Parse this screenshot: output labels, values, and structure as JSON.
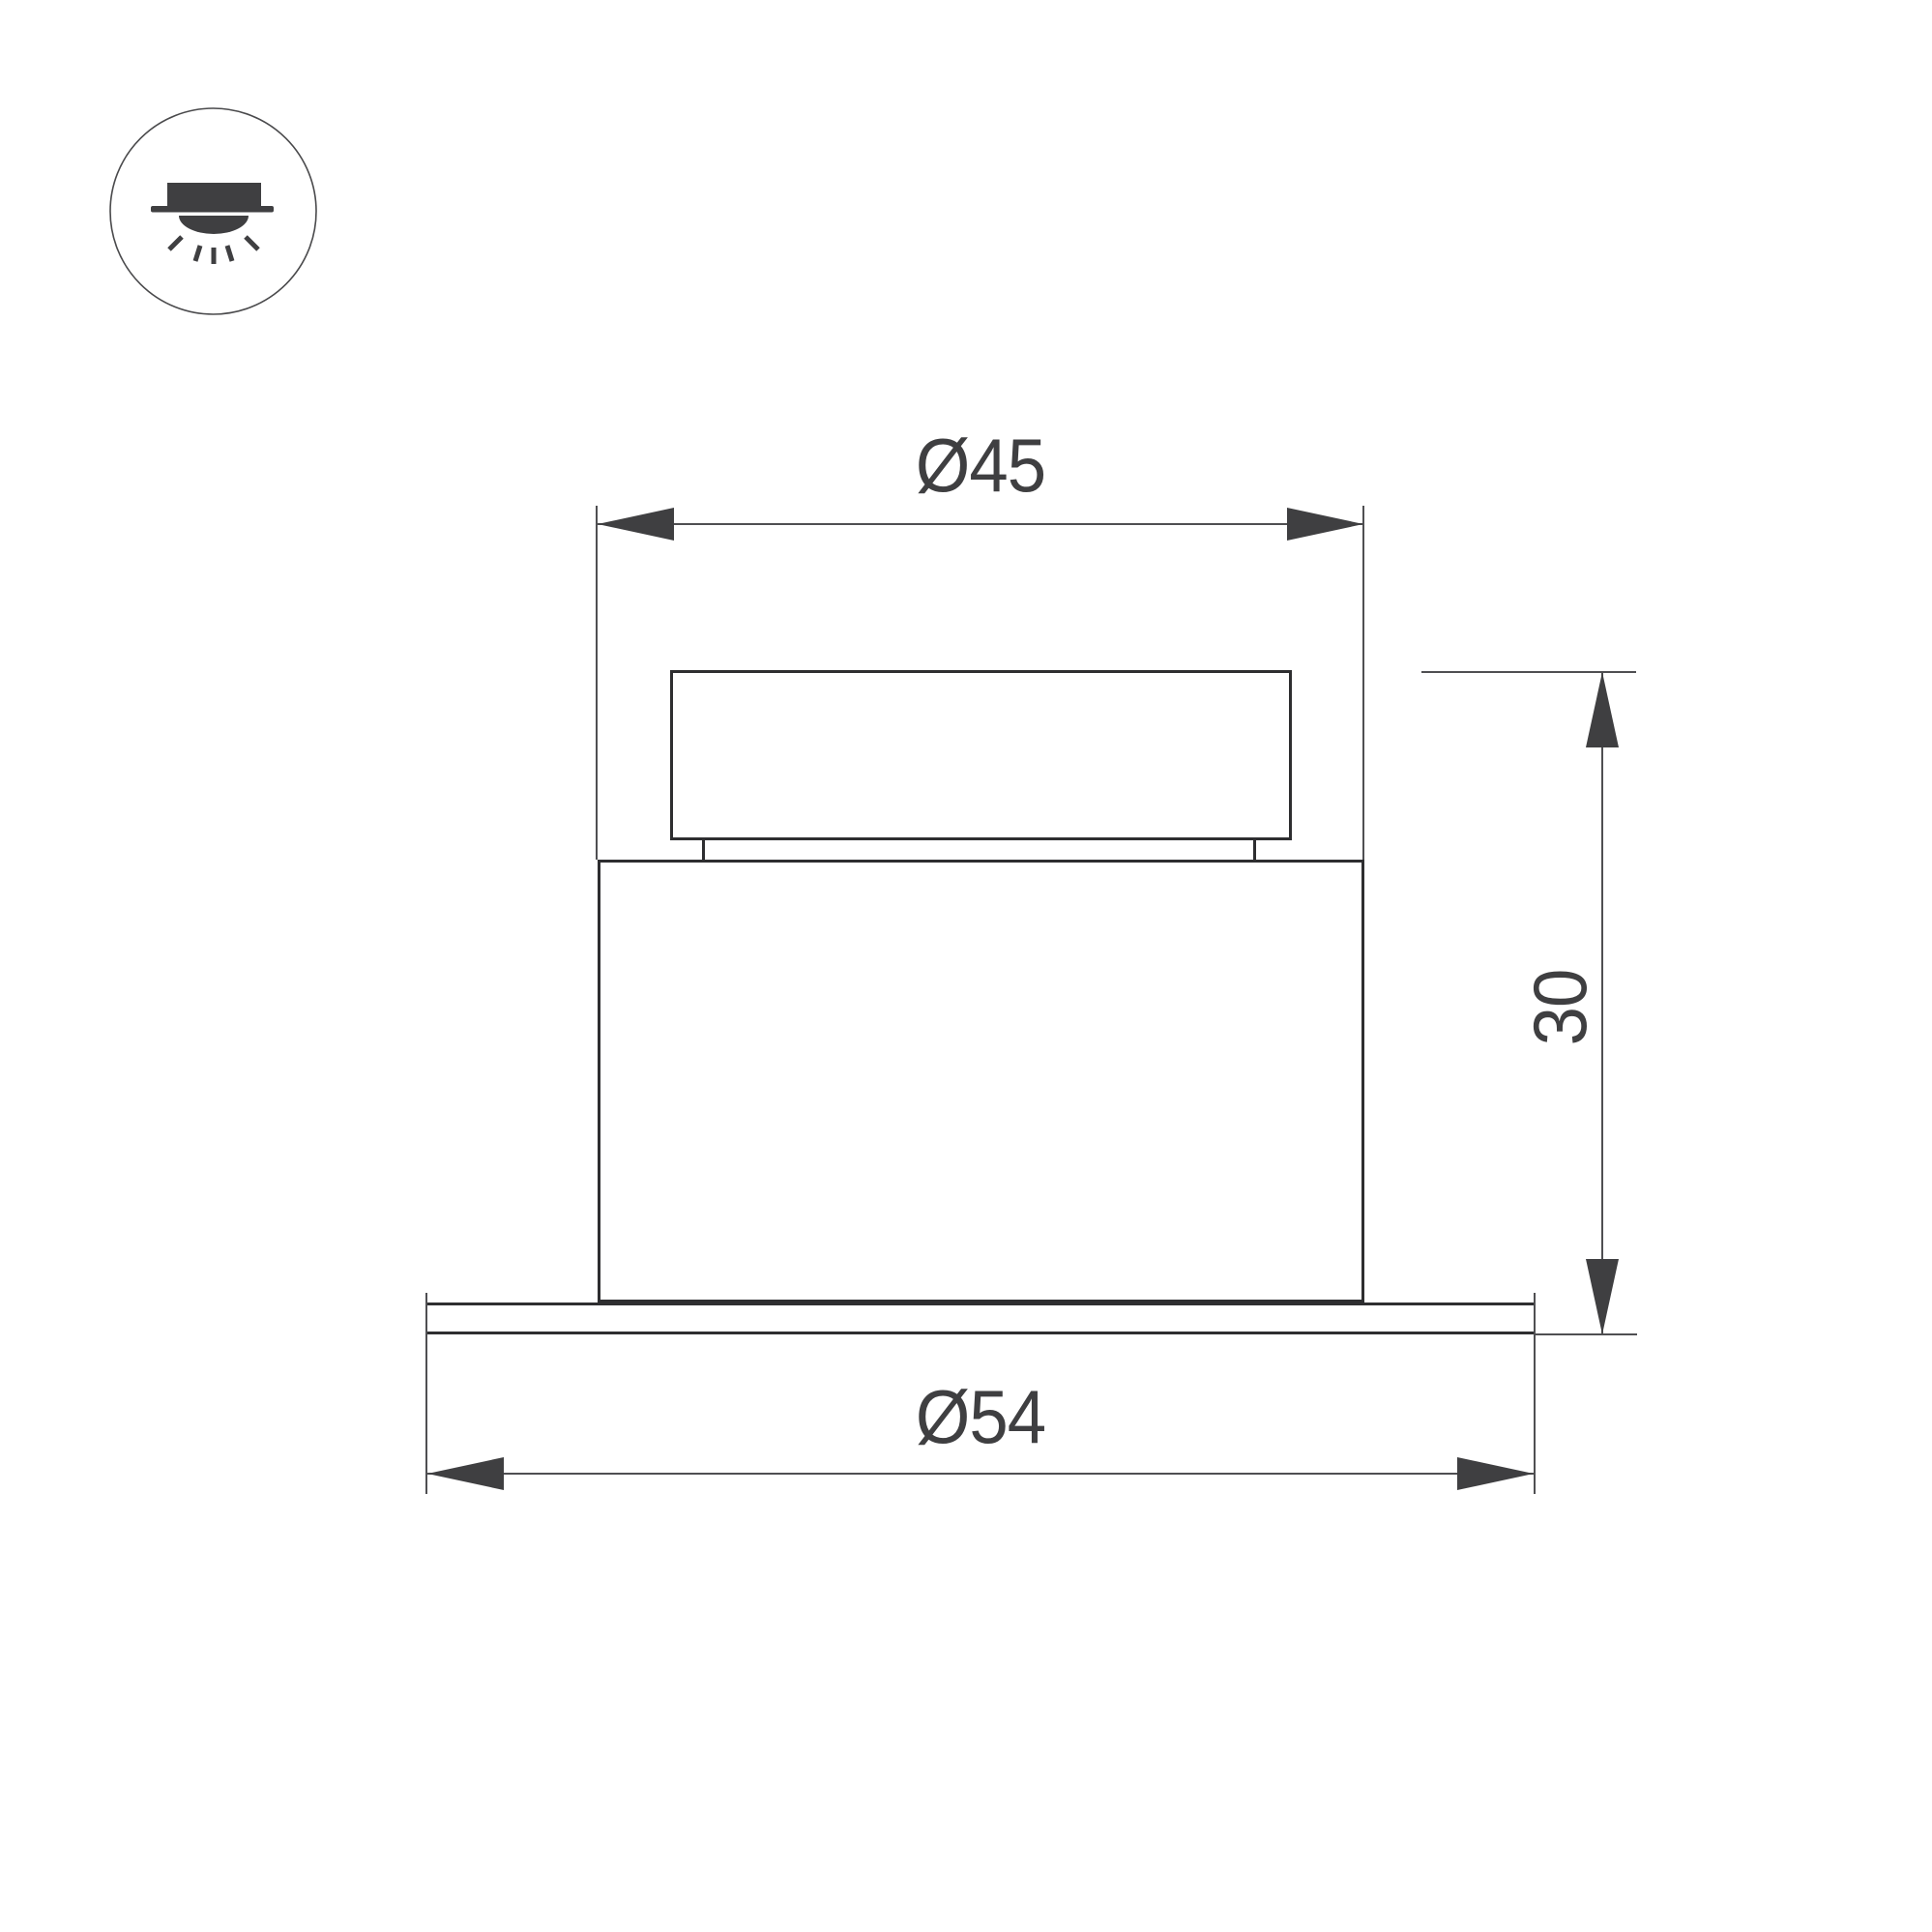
{
  "icon": {
    "name": "recessed-downlight",
    "description": "circle badge with recessed ceiling light shining downward"
  },
  "dimensions": {
    "top_diameter_label": "Ø45",
    "flange_diameter_label": "Ø54",
    "height_label": "30"
  },
  "colors": {
    "outline": "#2e2e30",
    "dimline": "#4f4f52",
    "arrow": "#3f3f41",
    "text": "#3f3f41",
    "bg": "#ffffff"
  }
}
